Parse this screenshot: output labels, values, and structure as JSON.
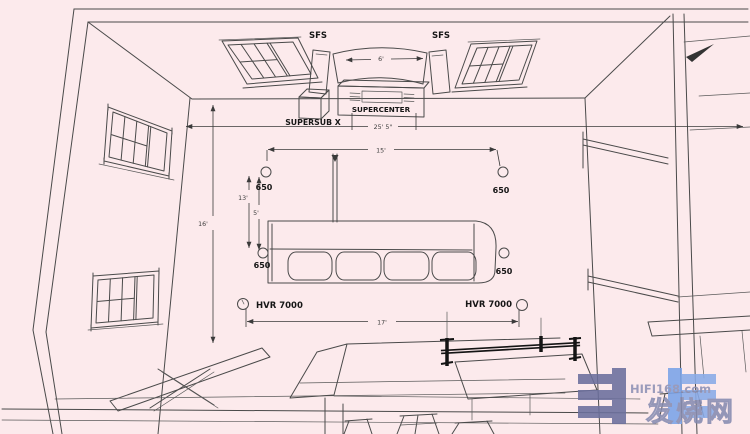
{
  "title": "Home theater room layout - perspective line drawing",
  "colors": {
    "background": "#fceaec",
    "line": "#4a4a4a",
    "dark_rail": "#141414",
    "watermark_slate": "#6b6f9d",
    "watermark_blue": "#7aa3e8",
    "watermark_text": "#8d91b5"
  },
  "labels": {
    "front_left_speaker": "SFS",
    "front_right_speaker": "SFS",
    "center_speaker": "SUPERCENTER",
    "subwoofer": "SUPERSUB X",
    "surround_front_left": "650",
    "surround_front_right": "650",
    "surround_rear_left": "650",
    "surround_rear_right": "650",
    "rear_left_speaker": "HVR 7000",
    "rear_right_speaker": "HVR 7000"
  },
  "dimensions": {
    "screen_width": "6'",
    "room_width": "25' 5\"",
    "front_stage_width": "15'",
    "room_depth": "16'",
    "front_to_rear_distance": "13'",
    "sofa_distance": "5'",
    "rear_speaker_spread": "17'"
  },
  "watermark": {
    "site": "HIFI168.com",
    "brand": "发烧网"
  }
}
